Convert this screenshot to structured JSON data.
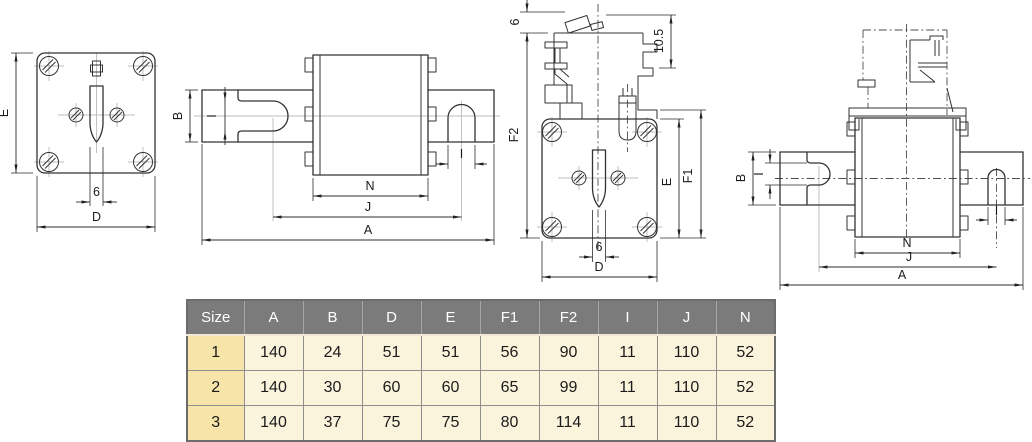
{
  "page": {
    "background": "#ffffff"
  },
  "drawings": {
    "line_color": "#333333",
    "centerline_color": "#bcbcbc",
    "front_view": {
      "labels": {
        "E": "E",
        "slot_width": "6",
        "D": "D"
      }
    },
    "side_view": {
      "labels": {
        "B": "B",
        "I_left": "I",
        "I_right": "I",
        "N": "N",
        "J": "J",
        "A": "A"
      }
    },
    "front_view_indicator": {
      "labels": {
        "striker_travel": "6",
        "overtravel": "10.5",
        "F2": "F2",
        "E": "E",
        "F1": "F1",
        "slot_width": "6",
        "D": "D"
      }
    },
    "side_view_indicator": {
      "labels": {
        "B": "B",
        "I_left": "I",
        "I_right": "I",
        "N": "N",
        "J": "J",
        "A": "A"
      }
    }
  },
  "table": {
    "columns": [
      "Size",
      "A",
      "B",
      "D",
      "E",
      "F1",
      "F2",
      "I",
      "J",
      "N"
    ],
    "rows": [
      [
        "1",
        "140",
        "24",
        "51",
        "51",
        "56",
        "90",
        "11",
        "110",
        "52"
      ],
      [
        "2",
        "140",
        "30",
        "60",
        "60",
        "65",
        "99",
        "11",
        "110",
        "52"
      ],
      [
        "3",
        "140",
        "37",
        "75",
        "75",
        "80",
        "114",
        "11",
        "110",
        "52"
      ]
    ],
    "colors": {
      "header_bg": "#7b7b7b",
      "header_text": "#ffffff",
      "size_col_bg": "#f7e4a8",
      "cell_bg": "#fbf4dc",
      "grid": "#8f8f8f",
      "text": "#1b1b1b"
    }
  }
}
